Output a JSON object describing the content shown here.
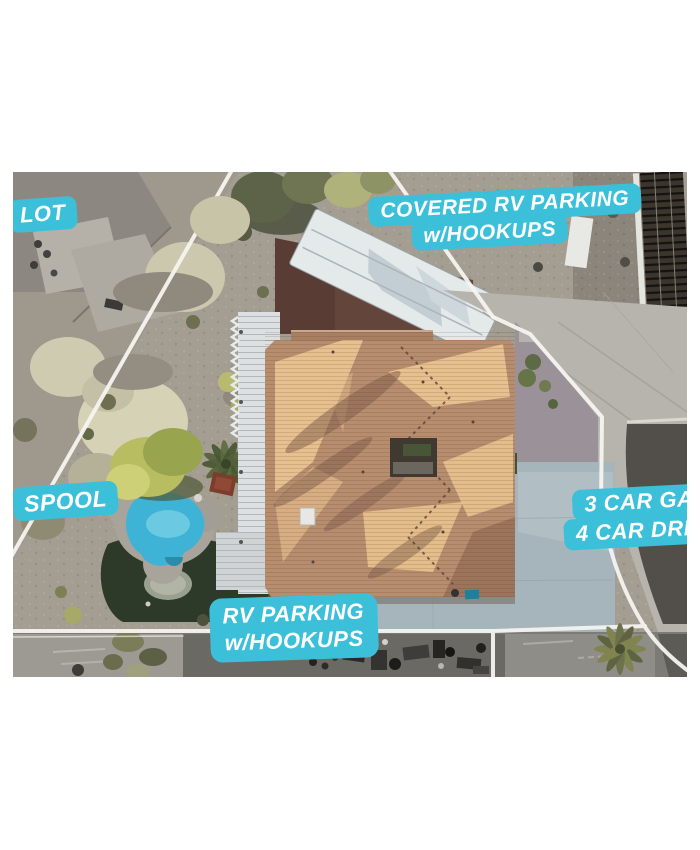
{
  "photo": {
    "description": "Aerial drone view of a residential property with real-estate feature callouts",
    "annotation_bg_color": "#3cc0da",
    "annotation_text_color": "#ffffff",
    "annotations": {
      "lot": {
        "text": "LOT"
      },
      "covered_rv": {
        "line1": "COVERED RV PARKING",
        "line2": "w/HOOKUPS"
      },
      "spool": {
        "text": "SPOOL"
      },
      "garage": {
        "line1": "3 CAR GARAGE",
        "line2": "4 CAR DRIVEWAY"
      },
      "rv_parking": {
        "line1": "RV PARKING",
        "line2": "w/HOOKUPS"
      }
    }
  }
}
